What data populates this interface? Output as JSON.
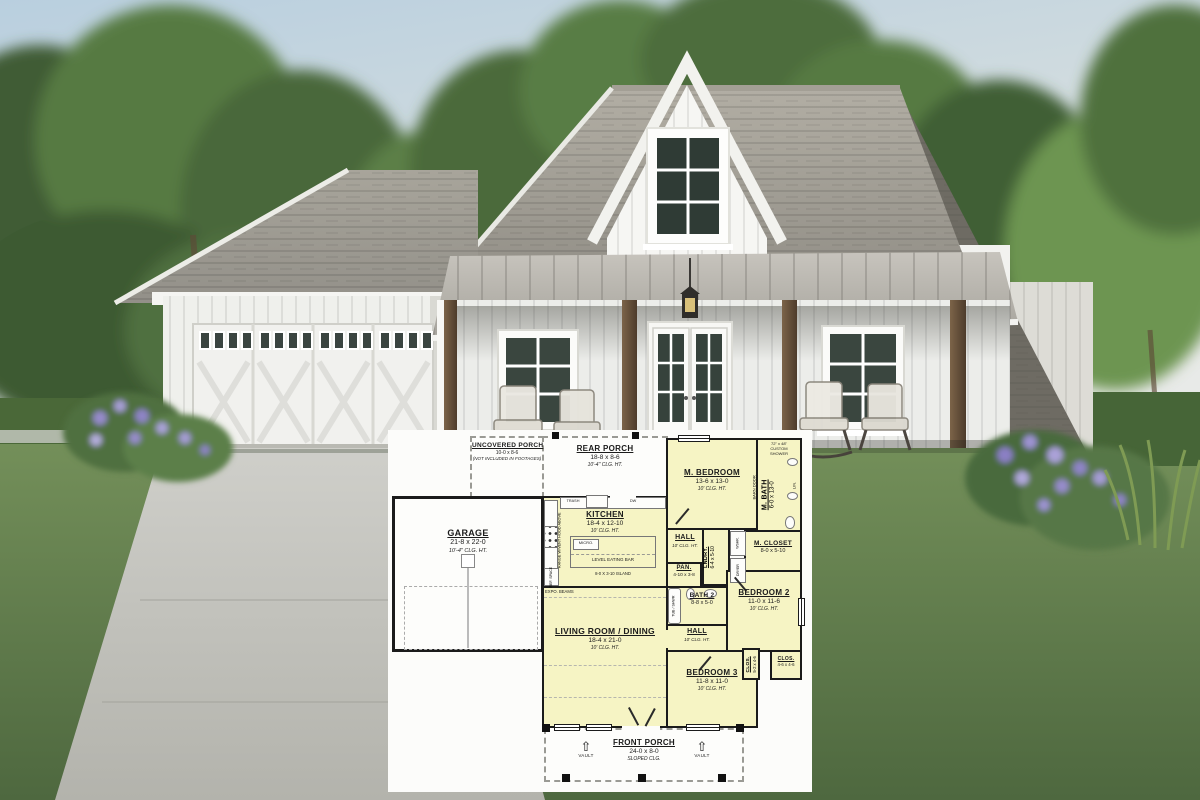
{
  "scene": {
    "palette": {
      "sky_top": "#b9cfdf",
      "sky_bottom": "#e8eae8",
      "foliage_dark": "#3f5c35",
      "foliage_mid": "#567a42",
      "foliage_bright": "#6d9551",
      "roof_shingle": "#9b978e",
      "roof_shadow": "#6e6b63",
      "metal_porch_roof": "#b7b4ac",
      "siding_white": "#f2f2ef",
      "post_wood": "#6b5540",
      "lawn": "#6a8753",
      "driveway": "#c9c9c3",
      "hedge": "#49673a",
      "flower_purple": "#968bcb",
      "glass_dark": "#36423c"
    }
  },
  "plan": {
    "colors": {
      "room_fill": "#f6f4c4",
      "wall": "#1b1b1b",
      "paper": "#fcfcfa"
    },
    "rooms": {
      "uncovered_porch": {
        "name": "UNCOVERED PORCH",
        "dims": "10-0 x 8-6",
        "note": "(NOT INCLUDED IN FOOTAGES)"
      },
      "rear_porch": {
        "name": "REAR PORCH",
        "dims": "18-8 x 8-6",
        "clg": "10'-4\" CLG. HT."
      },
      "m_bedroom": {
        "name": "M. BEDROOM",
        "dims": "13-6 x 13-0",
        "clg": "10' CLG. HT."
      },
      "m_bath": {
        "name": "M. BATH",
        "dims": "6-0 x 13-0"
      },
      "kitchen": {
        "name": "KITCHEN",
        "dims": "18-4 x 12-10",
        "clg": "10' CLG. HT."
      },
      "hall_upper": {
        "name": "HALL",
        "clg": "10' CLG. HT."
      },
      "laundry": {
        "name": "LNDRY.",
        "dims": "6-4 x 5-10"
      },
      "m_closet": {
        "name": "M. CLOSET",
        "dims": "8-0 x 5-10"
      },
      "pantry": {
        "name": "PAN.",
        "dims": "4-10 x 3-8"
      },
      "bath2": {
        "name": "BATH 2",
        "dims": "8-8 x 5-0"
      },
      "bedroom2": {
        "name": "BEDROOM 2",
        "dims": "11-0 x 11-6",
        "clg": "10' CLG. HT."
      },
      "hall_lower": {
        "name": "HALL",
        "clg": "10' CLG. HT."
      },
      "living": {
        "name": "LIVING ROOM / DINING",
        "dims": "18-4 x 21-0",
        "clg": "10' CLG. HT."
      },
      "bedroom3": {
        "name": "BEDROOM 3",
        "dims": "11-8 x 11-0",
        "clg": "10' CLG. HT."
      },
      "closet_a": {
        "name": "CLOS.",
        "dims": "5-2 x 4-6"
      },
      "closet_b": {
        "name": "CLOS.",
        "dims": "4-6 x 4-6"
      },
      "garage": {
        "name": "GARAGE",
        "dims": "21-8 x 22-0",
        "clg": "10'-4\" CLG. HT."
      },
      "front_porch": {
        "name": "FRONT PORCH",
        "dims": "24-0 x 8-0",
        "clg": "SLOPED CLG."
      }
    },
    "annotations": {
      "custom_shower_1": "72\" x 48\"",
      "custom_shower_2": "CUSTOM",
      "custom_shower_3": "SHOWER",
      "barn_door": "BARN DOOR",
      "linen": "LIN.",
      "trash": "TRASH",
      "dw": "DW",
      "micro": "MICRO.",
      "range": "RANGE W/VENT HOOD ABOVE",
      "ref": "REF. SPACE",
      "eating_bar": "LEVEL EATING BAR",
      "island": "8-0 X 3-10 ISLAND",
      "washer": "WSHR.",
      "dryer": "DRYER",
      "tub_shower": "TUB / SHWR",
      "expo_beams": "EXPO. BEAMS",
      "vault": "VAULT"
    }
  }
}
